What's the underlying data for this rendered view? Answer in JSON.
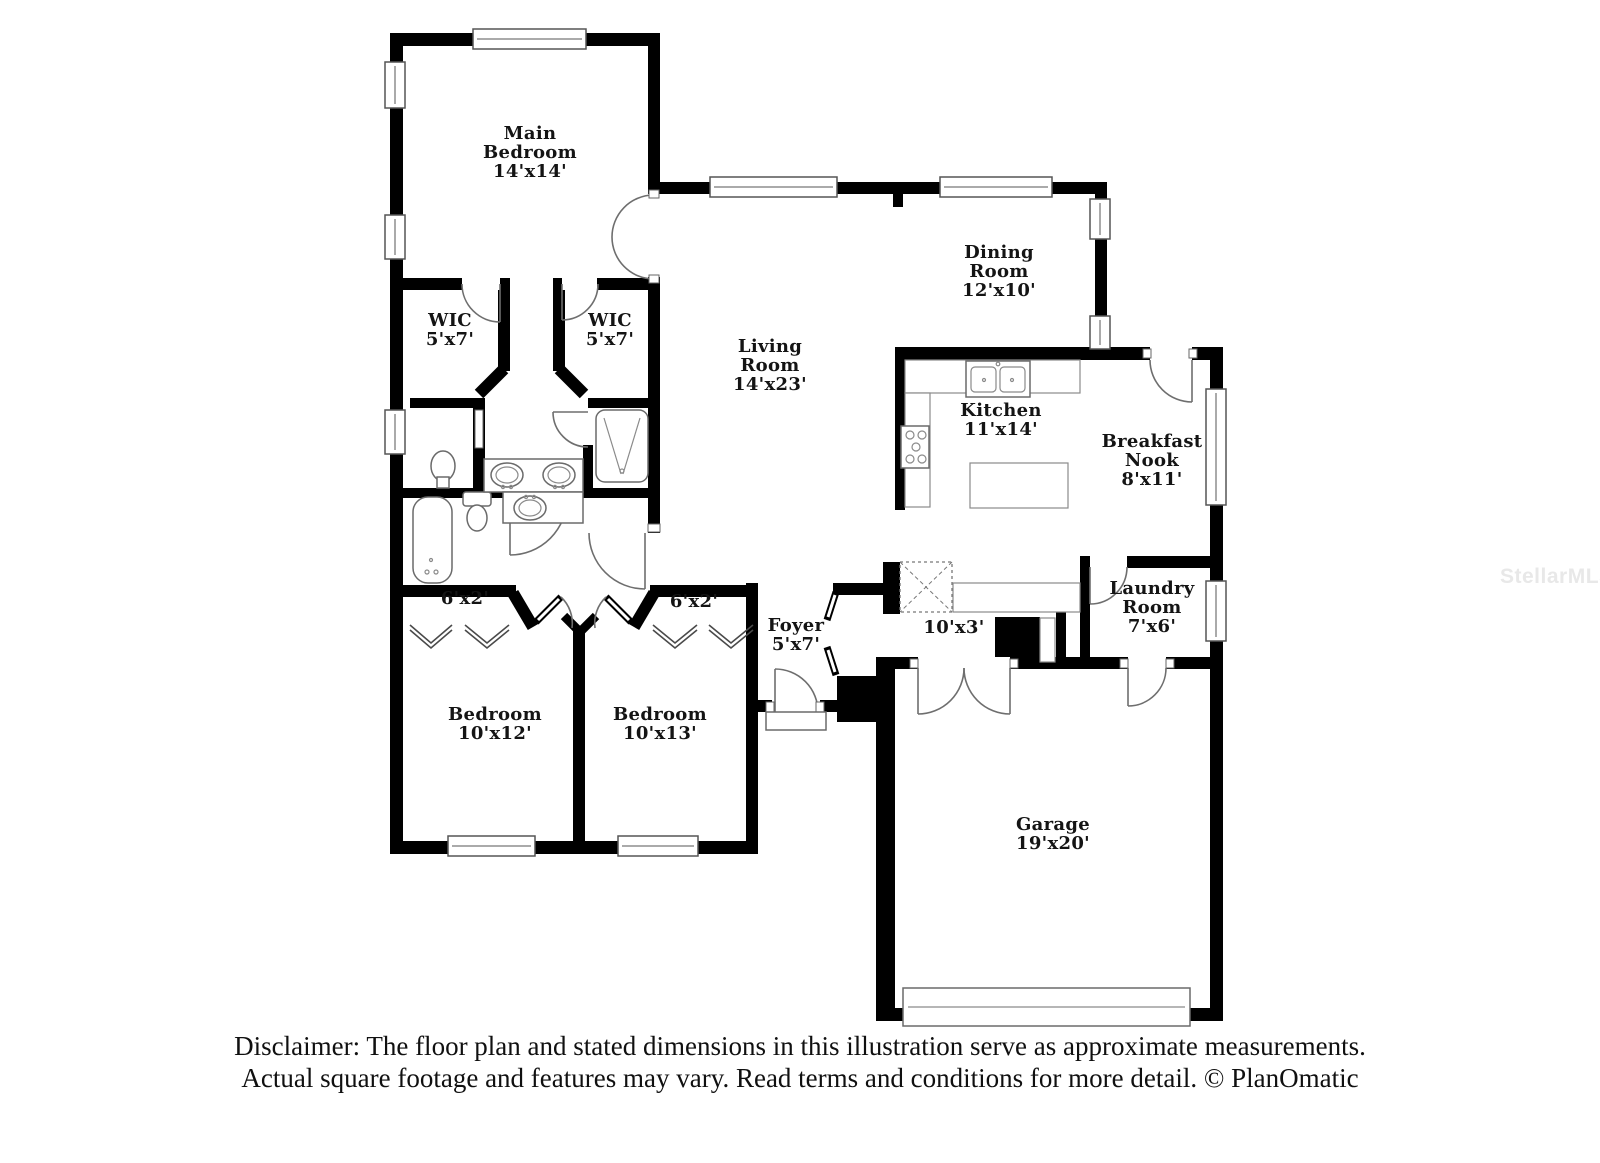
{
  "watermark": "StellarMLS",
  "labels": {
    "main_bedroom": "Main\nBedroom\n14'x14'",
    "wic_1": "WIC\n5'x7'",
    "wic_2": "WIC\n5'x7'",
    "living_room": "Living\nRoom\n14'x23'",
    "dining_room": "Dining\nRoom\n12'x10'",
    "kitchen": "Kitchen\n11'x14'",
    "breakfast_nook": "Breakfast\nNook\n8'x11'",
    "laundry_room": "Laundry\nRoom\n7'x6'",
    "foyer": "Foyer\n5'x7'",
    "hall": "10'x3'",
    "closet_left": "6'x2'",
    "closet_right": "6'x2'",
    "bedroom_1": "Bedroom\n10'x12'",
    "bedroom_2": "Bedroom\n10'x13'",
    "garage": "Garage\n19'x20'"
  },
  "disclaimer": {
    "line1": "Disclaimer: The floor plan and stated dimensions in this illustration serve as approximate measurements.",
    "line2": "Actual square footage and features may vary. Read terms and conditions for more detail. © PlanOmatic"
  }
}
